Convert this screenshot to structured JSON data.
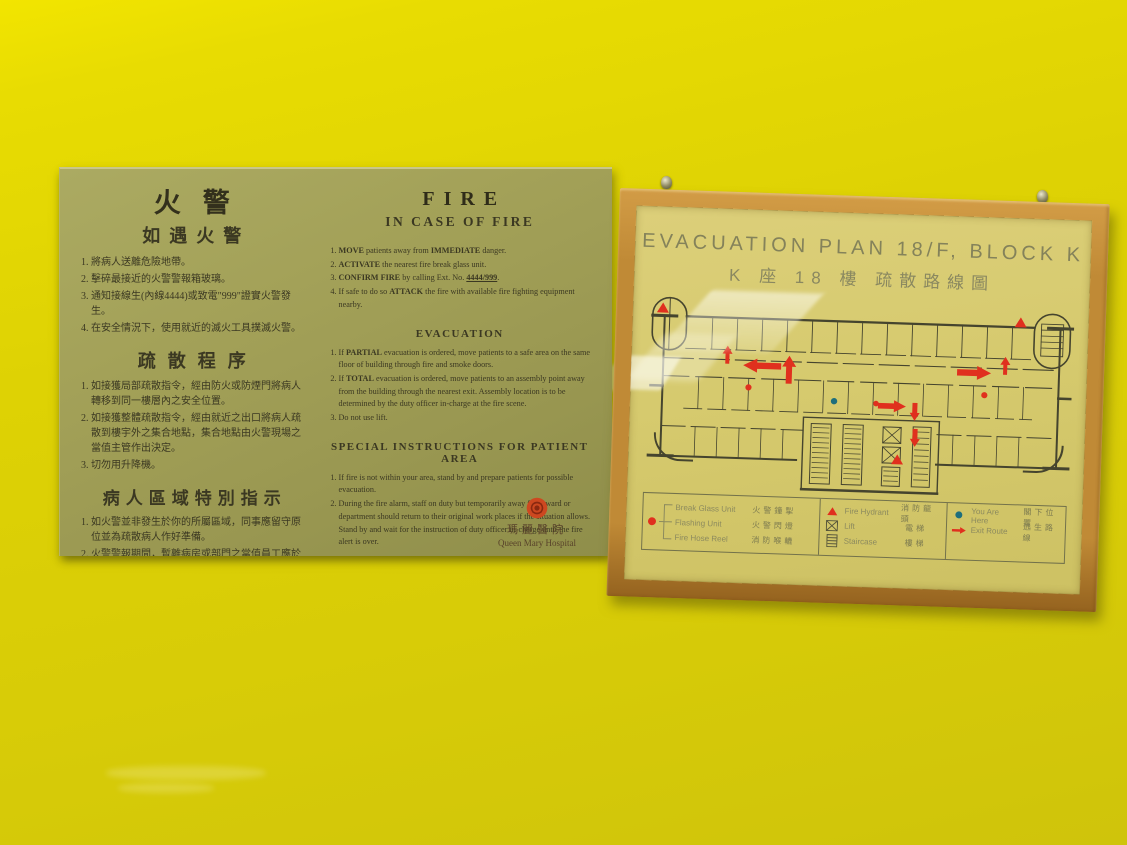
{
  "colors": {
    "marker_red": "#e0301e",
    "you_are_here_blue": "#1e6e7c",
    "wall_yellow": "#ddd104",
    "wood_frame": "#c08a36",
    "board_green": "#a3a158"
  },
  "fire_notice": {
    "chinese": {
      "title": "火警",
      "subtitle": "如遇火警",
      "alarm_steps": [
        "將病人送離危險地帶。",
        "擊碎最接近的火警警報箱玻璃。",
        "通知接線生(內線4444)或致電\"999\"證實火警發生。",
        "在安全情況下，使用就近的滅火工具撲滅火警。"
      ],
      "evacuation_title": "疏散程序",
      "evacuation_steps": [
        "如接獲局部疏散指令，經由防火或防煙門將病人轉移到同一樓層內之安全位置。",
        "如接獲整體疏散指令，經由就近之出口將病人疏散到樓宇外之集合地點，集合地點由火警現場之當值主管作出決定。",
        "切勿用升降機。"
      ],
      "patient_title": "病人區域特別指示",
      "patient_steps": [
        "如火警並非發生於你的所屬區域，同事應留守原位並為疏散病人作好準備。",
        "火警警報期間，暫離病房或部門之當值員工應於情況許可下返回其所屬之工作地點，留守原位並等候當值主管之指示直至警號解除。"
      ]
    },
    "english": {
      "title": "FIRE",
      "subtitle": "IN CASE OF FIRE",
      "alarm_steps": [
        {
          "pre": "",
          "b": "MOVE",
          "t": " patients away from ",
          "b2": "IMMEDIATE",
          "t2": " danger."
        },
        {
          "pre": "",
          "b": "ACTIVATE",
          "t": " the nearest fire break glass unit.",
          "b2": "",
          "t2": ""
        },
        {
          "pre": "",
          "b": "CONFIRM FIRE",
          "t": " by calling Ext. No. ",
          "b2": "4444/999",
          "t2": "."
        },
        {
          "pre": "If safe to do so ",
          "b": "ATTACK",
          "t": " the fire with available fire fighting equipment nearby.",
          "b2": "",
          "t2": ""
        }
      ],
      "evacuation_title": "EVACUATION",
      "evacuation_steps": [
        {
          "pre": "If ",
          "b": "PARTIAL",
          "t": " evacuation is ordered, move patients to a safe area on the same floor of building through fire and smoke doors.",
          "b2": "",
          "t2": ""
        },
        {
          "pre": "If ",
          "b": "TOTAL",
          "t": " evacuation is ordered, move patients to an assembly point away from the building through the nearest exit. Assembly location is to be determined by the duty officer in-charge at the fire scene.",
          "b2": "",
          "t2": ""
        },
        {
          "pre": "Do not use lift.",
          "b": "",
          "t": "",
          "b2": "",
          "t2": ""
        }
      ],
      "patient_title": "SPECIAL INSTRUCTIONS FOR PATIENT AREA",
      "patient_steps": [
        {
          "pre": "If fire is not within your area, stand by and prepare patients for possible evacuation.",
          "b": "",
          "t": "",
          "b2": "",
          "t2": ""
        },
        {
          "pre": "During the fire alarm, staff on duty but temporarily away from ward or department should return to their original work places if the situation allows. Stand by and wait for the instruction of duty officer in-charge until the fire alert is over.",
          "b": "",
          "t": "",
          "b2": "",
          "t2": ""
        }
      ],
      "org_chinese": "瑪麗醫院",
      "org_english": "Queen Mary Hospital"
    }
  },
  "evacuation_plan": {
    "title": "EVACUATION PLAN 18/F, BLOCK K",
    "subtitle": "K 座 18 樓 疏散路線圖",
    "legend": {
      "col1": [
        {
          "en": "Break Glass Unit",
          "zh": "火警鐘掣"
        },
        {
          "en": "Flashing Unit",
          "zh": "火警閃燈"
        },
        {
          "en": "Fire Hose Reel",
          "zh": "消防喉轆"
        }
      ],
      "col2": [
        {
          "en": "Fire Hydrant",
          "zh": "消防龍頭"
        },
        {
          "en": "Lift",
          "zh": "電梯"
        },
        {
          "en": "Staircase",
          "zh": "樓梯"
        }
      ],
      "col3": [
        {
          "en": "You Are Here",
          "zh": "閣下位置"
        },
        {
          "en": "Exit Route",
          "zh": "逃生路線"
        }
      ]
    }
  }
}
